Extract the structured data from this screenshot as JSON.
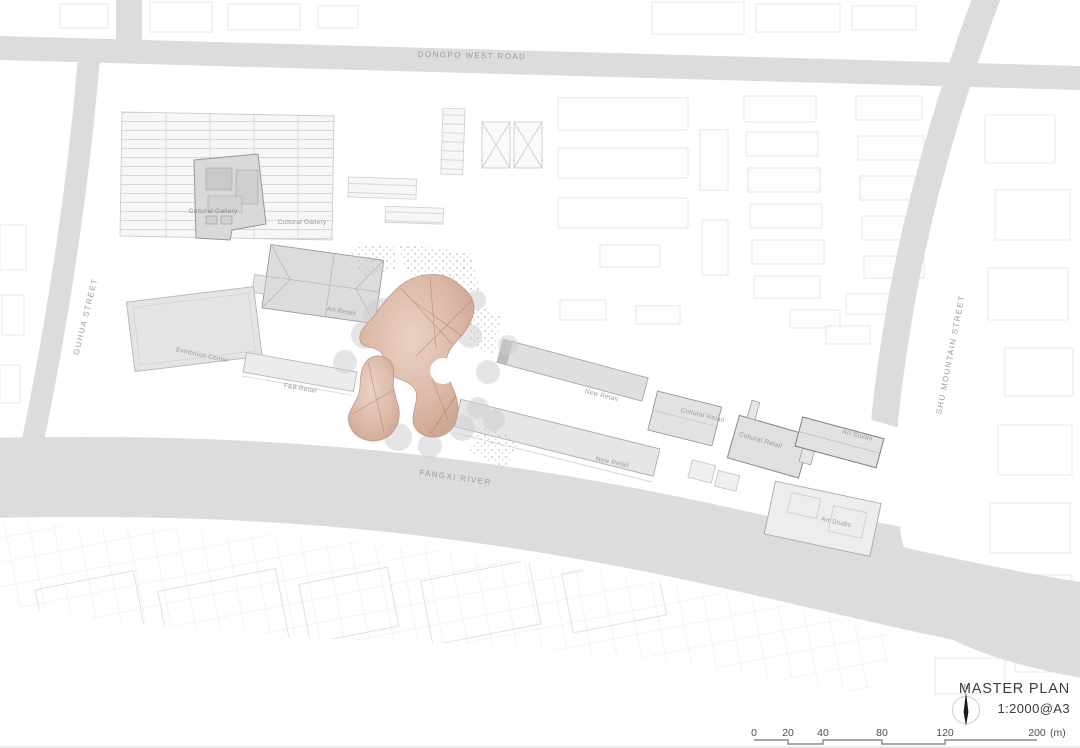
{
  "drawing": {
    "roads": {
      "dongpo_west_road": "DONGPO WEST ROAD",
      "guhua_street": "GUHUA STREET",
      "shu_mountain_street": "SHU MOUNTAIN STREET"
    },
    "river": {
      "label": "FANGXI RIVER"
    },
    "buildings": {
      "cultural_gallery_west": "Cultural Gallery",
      "cultural_gallery_east": "Cultural Gallery",
      "art_retail": "Art Retail",
      "exhibition_center": "Exhibition Center",
      "fb_retail": "F&B Retail",
      "new_retail_north": "New Retail",
      "new_retail_south": "New Retail",
      "cultural_retail_west": "Cultural Retail",
      "cultural_retail_east": "Cultural Retail",
      "art_studio_north": "Art Studio",
      "art_studio_south": "Art Studio"
    }
  },
  "title_block": {
    "north_label": "N",
    "title": "MASTER PLAN",
    "scale_note": "1:2000@A3"
  },
  "scale_bar": {
    "ticks": [
      "0",
      "20",
      "40",
      "80",
      "120",
      "200"
    ],
    "unit": "(m)"
  },
  "colors": {
    "road_fill": "#dcdcdc",
    "river_fill": "#dcdcdc",
    "canopy_accent": "#cfa28d",
    "canopy_ridge": "#a87f63",
    "building_fill": "#e3e3e3",
    "map_label_text": "#9b9b9b",
    "title_text": "#3d3d3d"
  }
}
